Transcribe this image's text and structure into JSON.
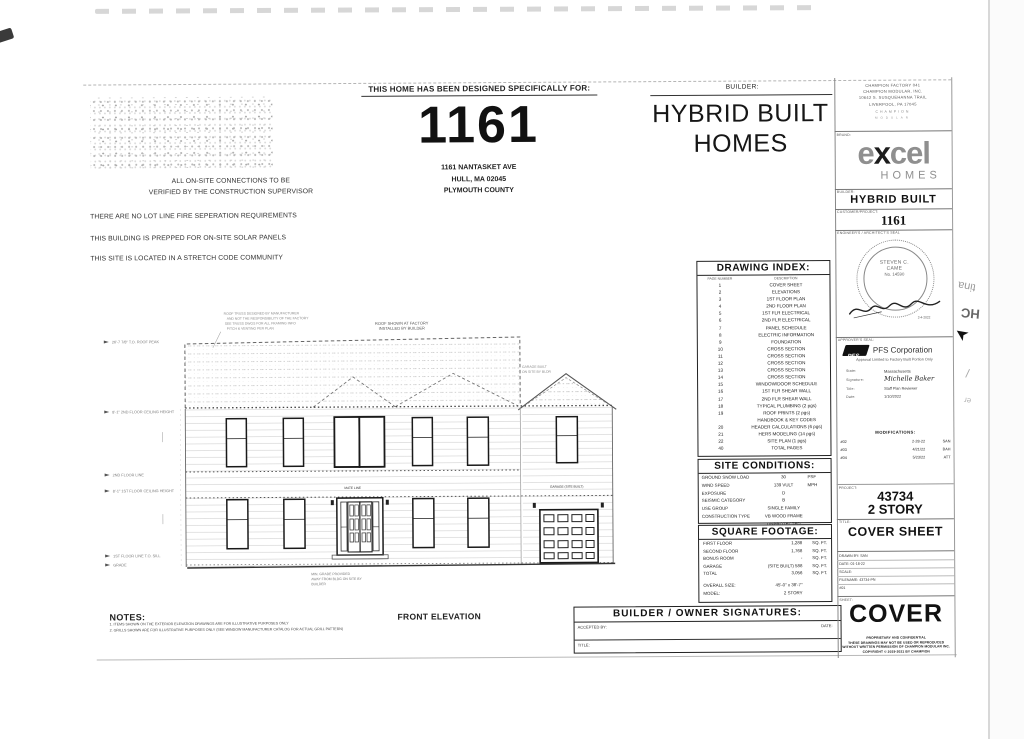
{
  "header": {
    "designed_for": "THIS HOME HAS BEEN DESIGNED SPECIFICALLY FOR:",
    "project_number": "1161",
    "address": [
      "1161 NANTASKET AVE",
      "HULL, MA 02045",
      "PLYMOUTH COUNTY"
    ],
    "builder_label": "BUILDER:",
    "builder_name": [
      "HYBRID BUILT",
      "HOMES"
    ]
  },
  "site_notes": [
    "ALL ON-SITE CONNECTIONS TO BE",
    "VERIFIED BY THE CONSTRUCTION SUPERVISOR",
    "THERE ARE NO LOT LINE FIRE SEPERATION REQUIREMENTS",
    "THIS BUILDING IS PREPPED FOR ON-SITE SOLAR PANELS",
    "THIS SITE IS LOCATED IN A STRETCH CODE COMMUNITY"
  ],
  "drawing_index": {
    "title": "DRAWING INDEX:",
    "col_headers": [
      "PAGE NUMBER",
      "DESCRIPTION"
    ],
    "rows": [
      [
        "1",
        "COVER SHEET"
      ],
      [
        "2",
        "ELEVATIONS"
      ],
      [
        "3",
        "1ST FLOOR PLAN"
      ],
      [
        "4",
        "2ND FLOOR PLAN"
      ],
      [
        "5",
        "1ST FLR ELECTRICAL"
      ],
      [
        "6",
        "2ND FLR ELECTRICAL"
      ],
      [
        "7",
        "PANEL SCHEDULE"
      ],
      [
        "8",
        "ELECTRIC INFORMATION"
      ],
      [
        "9",
        "FOUNDATION"
      ],
      [
        "10",
        "CROSS SECTION"
      ],
      [
        "11",
        "CROSS SECTION"
      ],
      [
        "12",
        "CROSS SECTION"
      ],
      [
        "13",
        "CROSS SECTION"
      ],
      [
        "14",
        "CROSS SECTION"
      ],
      [
        "15",
        "WINDOW/DOOR SCHEDULE"
      ],
      [
        "16",
        "1ST FLR SHEAR WALL"
      ],
      [
        "17",
        "2ND FLR SHEAR WALL"
      ],
      [
        "18",
        "TYPICAL PLUMBING (2 pgs)"
      ],
      [
        "19",
        "ROOF PRINTS (2 pgs)"
      ],
      [
        "",
        "HANDBOOK & KEY CODES"
      ],
      [
        "20",
        "HEADER CALCULATIONS (6 pgs)"
      ],
      [
        "21",
        "HERS MODELING (14 pgs)"
      ],
      [
        "22",
        "SITE PLAN (1 pgs)"
      ],
      [
        "40",
        "TOTAL PAGES"
      ]
    ]
  },
  "site_conditions": {
    "title": "SITE CONDITIONS:",
    "rows": [
      [
        "GROUND SNOW LOAD",
        "30",
        "PSF"
      ],
      [
        "WIND SPEED",
        "139 VULT",
        "MPH"
      ],
      [
        "EXPOSURE",
        "D",
        ""
      ],
      [
        "SEISMIC CATEGORY",
        "B",
        ""
      ],
      [
        "USE GROUP",
        "SINGLE FAMILY",
        ""
      ],
      [
        "CONSTRUCTION TYPE",
        "VB WOOD FRAME UNPROTECTED",
        ""
      ]
    ]
  },
  "square_footage": {
    "title": "SQUARE FOOTAGE:",
    "rows": [
      [
        "FIRST FLOOR",
        "1,288",
        "SQ. FT."
      ],
      [
        "SECOND FLOOR",
        "1,768",
        "SQ. FT."
      ],
      [
        "BONUS ROOM",
        "-",
        "SQ. FT."
      ],
      [
        "GARAGE",
        "(SITE BUILT) 588",
        "SQ. FT."
      ],
      [
        "TOTAL",
        "3,056",
        "SQ. FT."
      ]
    ],
    "overall_size_label": "OVERALL SIZE:",
    "overall_size": "45'-0\" x 38'-7\"",
    "model_label": "MODEL:",
    "model": "2 STORY"
  },
  "signatures": {
    "title": "BUILDER / OWNER  SIGNATURES:",
    "accepted_by_label": "ACCEPTED BY:",
    "date_label": "DATE:",
    "title_label": "TITLE:"
  },
  "notes": {
    "title": "NOTES:",
    "items": [
      "1. ITEMS SHOWN ON THE EXTERIOR ELEVATION DRAWINGS ARE FOR ILLUSTRATIVE PURPOSES ONLY",
      "2. GRILLS SHOWN ARE FOR ILLUSTRATIVE PURPOSES ONLY (SEE WINDOW MANUFACTURER CATALOG FOR ACTUAL GRILL PATTERN)"
    ]
  },
  "elevation": {
    "caption": "FRONT ELEVATION",
    "roof_note": [
      "ROOF SHOWN AT FACTORY",
      "INSTALLED BY BUILDER"
    ],
    "roof_annotation": [
      "ROOF TRUSS DESIGNED BY MANUFACTURER",
      "AND NOT THE RESPONSIBILITY OF THE FACTORY",
      "SEE TRUSS DWGS FOR ALL FRAMING INFO",
      "PITCH & VENTING PER PLAN"
    ],
    "garage_note": [
      "GARAGE BUILT",
      "ON SITE BY BLDR"
    ],
    "grade_note": [
      "MIN. GRADE PROVIDED",
      "AWAY FROM BLDG ON SITE BY",
      "BUILDER"
    ],
    "mate_label": "MATE LINE",
    "garage_label": "GARAGE (SITE BUILT)",
    "dims": [
      "26'-7 7/8\" T.O. ROOF PEAK",
      "8'-1\" 2ND FLOOR CEILING HEIGHT",
      "2ND FLOOR LINE",
      "8'-1\" 1ST FLOOR CEILING HEIGHT",
      "1ST FLOOR LINE  T.O. SILL",
      "GRADE"
    ]
  },
  "title_block": {
    "factory": [
      "CHAMPION FACTORY 041",
      "CHAMPION MODULAR, INC.",
      "10642 S. SUSQUEHANNA TRAIL",
      "LIVERPOOL, PA  17045"
    ],
    "factory_brand1": "CHAMPION",
    "factory_brand2": "MODULAR",
    "brand_label": "BRAND:",
    "logo_excel": "excel",
    "logo_homes": "HOMES",
    "builder_label": "BUILDER:",
    "builder": "HYBRID BUILT",
    "customer_label": "CUSTOMER/PROJECT:",
    "customer": "1161",
    "seal_label": "ENGINEER'S / ARCHITECT'S SEAL",
    "seal_name1": "STEVEN C.",
    "seal_name2": "CAME",
    "seal_number": "No. 14590",
    "seal_date": "2-4-2022",
    "approver_label": "APPROVER'S SEAL:",
    "approver_logo": "PFS",
    "approver_company": "PFS Corporation",
    "approver_note": "Approval Limited to Factory Built Portion Only",
    "state_label": "State:",
    "state": "Massachusetts",
    "signature_label": "Signature:",
    "signature": "Michelle Baker",
    "title_label": "Title:",
    "approver_title": "Staff Plan Reviewer",
    "date_label": "Date:",
    "approver_date": "1/10/2022",
    "modifications_label": "MODIFICATIONS:",
    "modifications": [
      [
        "#02",
        "2-28-22",
        "SAN"
      ],
      [
        "#03",
        "4/21/22",
        "BAH"
      ],
      [
        "#04",
        "5/23/22",
        "ATT"
      ]
    ],
    "project_label": "PROJECT:",
    "project_number": "43734",
    "project_model": "2 STORY",
    "sheet_title_label": "TITLE:",
    "sheet_title": "COVER SHEET",
    "drawn_by_label": "DRAWN BY:",
    "drawn_by": "SAN",
    "tb_date_label": "DATE:",
    "tb_date": "01-18-22",
    "scale_label": "SCALE:",
    "filename_label": "FILENAME:",
    "filename": "43734-PN",
    "rev": "#01",
    "sheet_label": "SHEET:",
    "sheet": "COVER",
    "proprietary": [
      "PROPRIETARY AND CONFIDENTIAL",
      "THESE DRAWINGS MAY NOT BE USED OR REPRODUCED",
      "WITHOUT WRITTEN PERMISSION OF CHAMPION MODULAR INC.",
      "COPYRIGHT © 2019-2021 BY CHAMPION"
    ]
  },
  "edge_bleed": {
    "g1": "tina",
    "g2": "HC",
    "g3": "➤",
    "g4": "/",
    "g5": "er"
  }
}
